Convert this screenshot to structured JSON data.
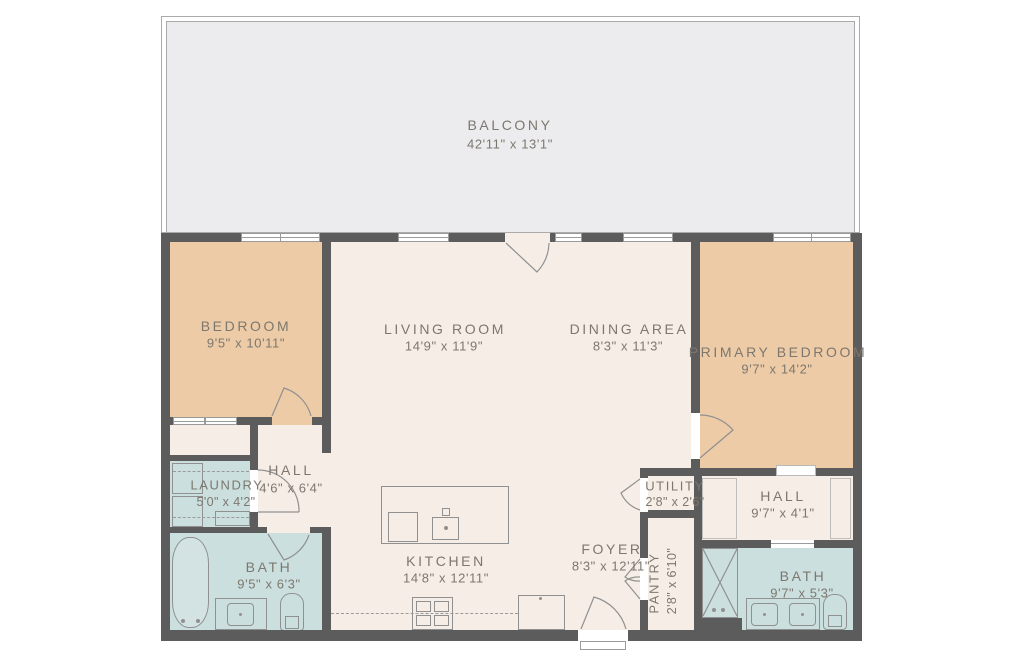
{
  "plan_title": "apartment-floor-plan",
  "rooms": [
    {
      "id": "balcony",
      "name": "BALCONY",
      "dims": "42'11\" x 13'1\""
    },
    {
      "id": "bedroom",
      "name": "BEDROOM",
      "dims": "9'5\" x 10'11\""
    },
    {
      "id": "living-room",
      "name": "LIVING ROOM",
      "dims": "14'9\" x 11'9\""
    },
    {
      "id": "dining-area",
      "name": "DINING AREA",
      "dims": "8'3\" x 11'3\""
    },
    {
      "id": "primary-bedroom",
      "name": "PRIMARY BEDROOM",
      "dims": "9'7\" x 14'2\""
    },
    {
      "id": "hall-left",
      "name": "HALL",
      "dims": "4'6\" x 6'4\""
    },
    {
      "id": "laundry",
      "name": "LAUNDRY",
      "dims": "5'0\" x 4'2\""
    },
    {
      "id": "bath-left",
      "name": "BATH",
      "dims": "9'5\" x 6'3\""
    },
    {
      "id": "kitchen",
      "name": "KITCHEN",
      "dims": "14'8\" x 12'11\""
    },
    {
      "id": "foyer",
      "name": "FOYER",
      "dims": "8'3\" x 12'11\""
    },
    {
      "id": "utility",
      "name": "UTILITY",
      "dims": "2'8\" x 2'6\""
    },
    {
      "id": "pantry",
      "name": "PANTRY",
      "dims": "2'8\" x 6'10\""
    },
    {
      "id": "hall-right",
      "name": "HALL",
      "dims": "9'7\" x 4'1\""
    },
    {
      "id": "bath-right",
      "name": "BATH",
      "dims": "9'7\" x 5'3\""
    }
  ],
  "colors": {
    "wall": "#5c5c5c",
    "floor_cream": "#f6eee6",
    "bedroom_peach": "#edcba7",
    "bath_teal": "#cbdfdf",
    "balcony_gray": "#ececee",
    "label_text": "#7c786f",
    "fixture_line": "#909090"
  }
}
